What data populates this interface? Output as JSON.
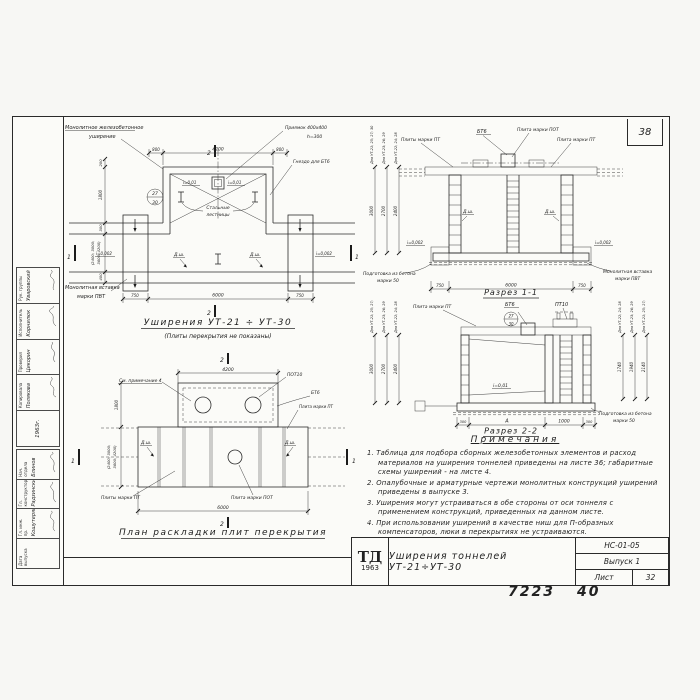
{
  "common": {
    "dsh": "Д.ш.",
    "slope001": "i=0,01",
    "slope002": "i=0,002",
    "bt6": "БТ6",
    "pt": "Плита марки ПТ",
    "pts": "Плиты марки ПТ",
    "pot": "Плита марки ПОТ",
    "insert1": "Монолитная вставка",
    "insert2": "марки ПВТ",
    "prep1": "Подготовка из бетона",
    "prep2": "марки 50",
    "d750": "750",
    "d6000": "6000",
    "d800": "800",
    "d4200": "4200",
    "d300": "300",
    "d1000": "1000",
    "d200": "200",
    "d400": "400",
    "d1800": "1800",
    "dA": "А",
    "brack1": "(2400; 3000;",
    "brack2": "3600; 4200)",
    "h3000": "3000",
    "h2700": "2700",
    "h2400": "2400",
    "ut1": "Для УТ-21; 25; 27; 30",
    "ut2": "Для УТ-23; 26; 29",
    "ut3": "Для УТ-22; 24; 28",
    "m1": "1",
    "m2": "2",
    "det27": "27",
    "det30": "30"
  },
  "plan": {
    "mono1": "Монолитное железобетонное",
    "mono2": "уширение",
    "pit1": "Приямок 400х400",
    "pit2": "h=300",
    "socket": "Гнездо для БТ6",
    "lad1": "Стальные",
    "lad2": "лестницы",
    "title": "Уширения УТ-21 ÷ УТ-30",
    "subtitle": "(Плиты перекрытия не показаны)"
  },
  "s1": {
    "title": "Разрез 1-1"
  },
  "s2": {
    "title": "Разрез 2-2",
    "pt10": "ПТ10",
    "r1": "1740",
    "r2": "1940",
    "r3": "2140"
  },
  "plan2": {
    "note4": "См. примечание 4",
    "pot10": "ПОТ10",
    "title": "План раскладки плит перекрытия"
  },
  "notes": {
    "title": "Примечания",
    "items": [
      "1. Таблица для подбора сборных железобетонных элементов и расход материалов на уширения тоннелей приведены на листе 36; габаритные схемы уширений - на листе 4.",
      "2. Опалубочные и арматурные чертежи монолитных конструкций уширений приведены в выпуске 3.",
      "3. Уширения могут устраиваться в обе стороны от оси тоннеля с применением конструкций, приведенных на данном листе.",
      "4. При использовании уширений в качестве ниш для П-образных компенсаторов, люки в перекрытиях не устраиваются."
    ]
  },
  "tb": {
    "logo1": "ТД",
    "logo2": "1963",
    "title": "Уширения тоннелей УТ-21÷УТ-30",
    "code": "НС-01-05",
    "issue": "Выпуск 1",
    "sheet": "Лист",
    "sheetNo": "32"
  },
  "page": {
    "corner": "38",
    "foot1": "7223",
    "foot2": "40"
  },
  "stamp": {
    "year": "1963г.",
    "a": [
      {
        "r": "Нач. отдела",
        "n": "Блинов"
      },
      {
        "r": "Гл. конструктор",
        "n": "Радзинский"
      },
      {
        "r": "Гл. инж. пр.",
        "n": "Кошутерян"
      },
      {
        "r": "Дата выпуска",
        "n": ""
      }
    ],
    "b": [
      {
        "r": "Рук. группы",
        "n": "Уваровский"
      },
      {
        "r": "Исполнитель",
        "n": "Корнилюк"
      },
      {
        "r": "Проверил",
        "n": "Цикорин"
      },
      {
        "r": "Копировала",
        "n": "Полякова"
      }
    ]
  }
}
